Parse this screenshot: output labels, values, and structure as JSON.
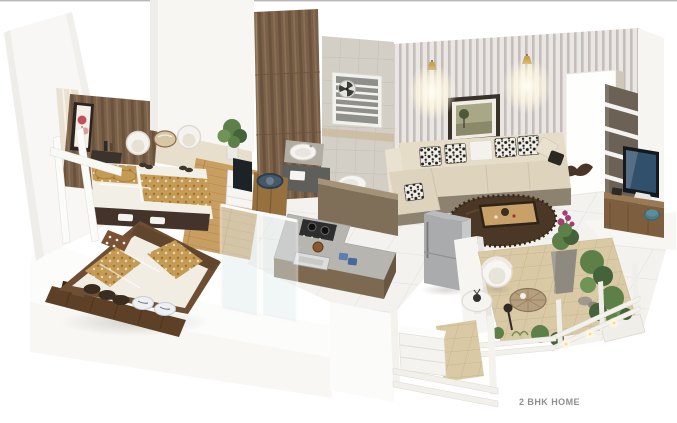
{
  "caption": "2 BHK HOME",
  "palette": {
    "bg": "#ffffff",
    "wall_white": "#f7f6f3",
    "wall_shade": "#eceae6",
    "floor_tile": "#f3f2ef",
    "floor_line": "#e4e2de",
    "door_panel": "#7a6048",
    "wood_mid": "#8a6a48",
    "wood_floor": "#c89e62",
    "bath_tile": "#d3cfc6",
    "stripe_wall": "#bab3b3",
    "sofa_cream": "#e6ddc9",
    "sofa_taupe": "#8d8170",
    "cushion_ink": "#23201c",
    "rug_brown": "#4a3726",
    "counter_top": "#b7b5b0",
    "counter_base": "#7d6950",
    "fridge_gray": "#a9abad",
    "bed_gold": "#c49a55",
    "terrace_tile": "#d9c9a4",
    "plant_green": "#5d8048",
    "plant_deep": "#44633a",
    "flower_magenta": "#a23f72",
    "glass_blue": "#e2ecec",
    "caption_gray": "#8f8f8f"
  }
}
